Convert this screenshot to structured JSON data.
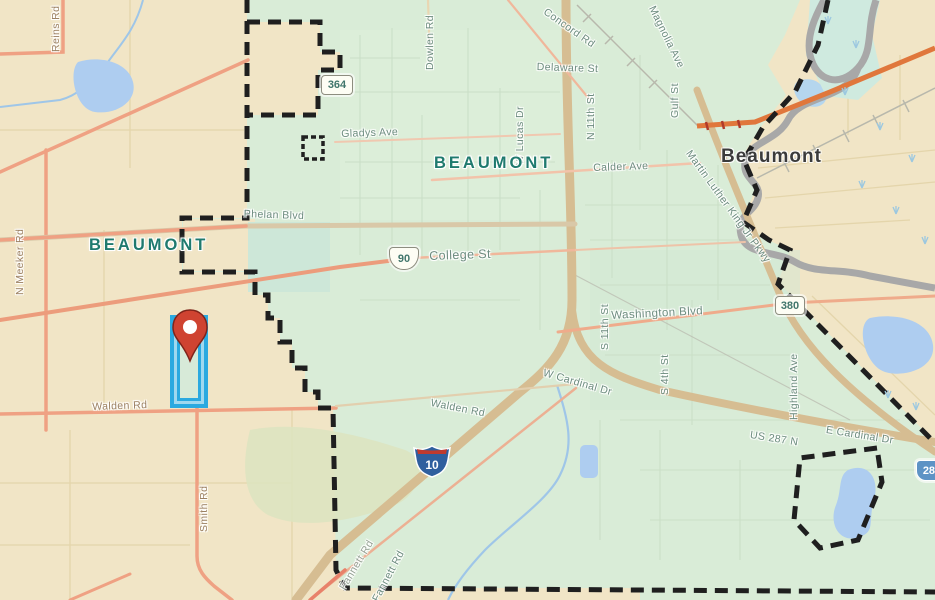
{
  "map": {
    "city_limit_label": "BEAUMONT",
    "place_label": "Beaumont",
    "roads": {
      "reins": "Reins Rd",
      "n_meeker": "N Meeker Rd",
      "dowlen": "Dowlen Rd",
      "gladys": "Gladys Ave",
      "phelan": "Phelan Blvd",
      "concord": "Concord Rd",
      "delaware": "Delaware St",
      "n_11th": "N 11th St",
      "w_lucas": "W Lucas Dr",
      "magnolia": "Magnolia Ave",
      "gulf": "Gulf St",
      "mlk": "Martin Luther King Jr Pkwy",
      "calder": "Calder Ave",
      "college": "College St",
      "washington": "Washington Blvd",
      "s_11th": "S 11th St",
      "s_4th": "S 4th St",
      "highland": "Highland Ave",
      "us_287_n": "US 287 N",
      "e_cardinal": "E Cardinal Dr",
      "w_cardinal": "W Cardinal Dr",
      "walden_west": "Walden Rd",
      "walden_center": "Walden Rd",
      "smith": "Smith Rd",
      "fannett": "Fannett Rd",
      "fannett_ghost": "Fannett Rd"
    },
    "shields": {
      "tx364": "364",
      "us90": "90",
      "tx380": "380",
      "i10": "10",
      "us287": "287"
    },
    "colors": {
      "outside_city": "#f1e5c6",
      "city_fill": "#d9ecd7",
      "city_boundary": "#1f1f1f",
      "water": "#aecdf0",
      "river_outline": "#a8a8a8",
      "major_road_salmon": "#efa183",
      "highway_orange": "#e0773c",
      "freeway_tan": "#d6bd92",
      "parcel_highlight": "#2aa9e0",
      "pin_red": "#cf4331",
      "city_label_teal": "#1f7a6e"
    }
  }
}
